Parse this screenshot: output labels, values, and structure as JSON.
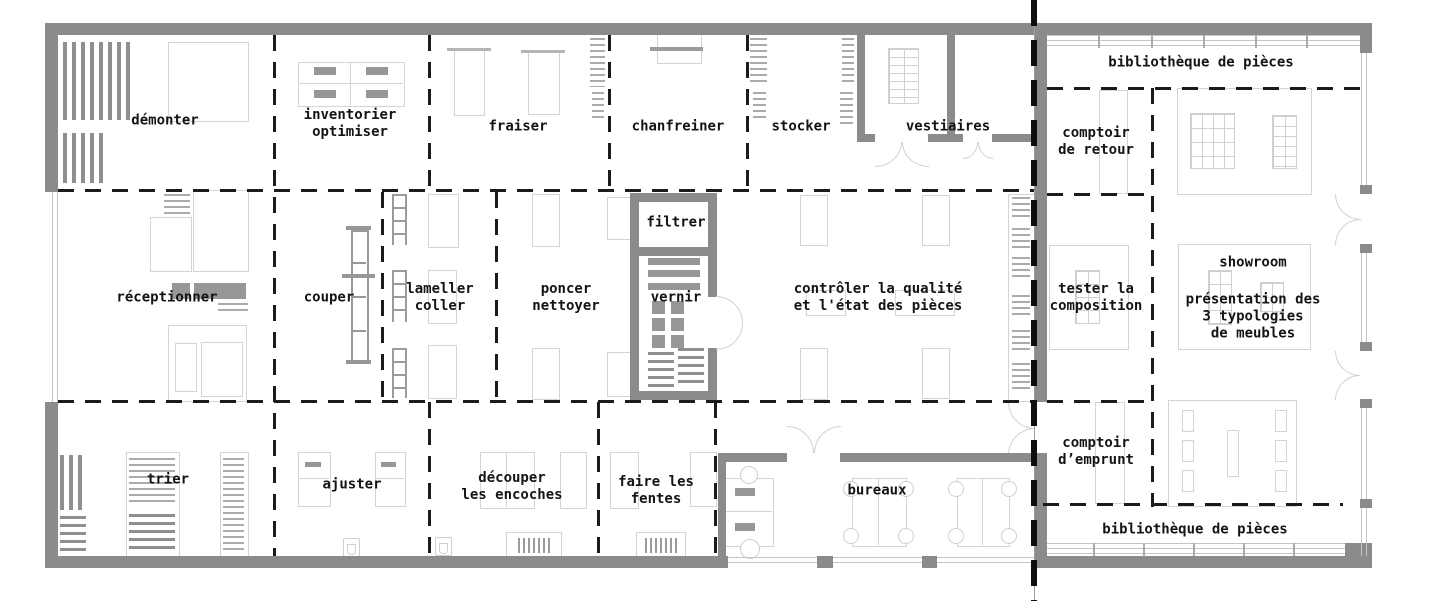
{
  "colors": {
    "wall": "#8b8b8b",
    "partition_line": "#1b1b1b",
    "section_cut_line": "#0e0e0e",
    "furniture_outline": "#d4d4d4",
    "furniture_fill": "#979797",
    "text": "#141414"
  },
  "rooms": [
    {
      "id": "demonter",
      "label": "démonter"
    },
    {
      "id": "inventorier-optimiser",
      "label": "inventorier\noptimiser"
    },
    {
      "id": "fraiser",
      "label": "fraiser"
    },
    {
      "id": "chanfreiner",
      "label": "chanfreiner"
    },
    {
      "id": "stocker",
      "label": "stocker"
    },
    {
      "id": "vestiaires",
      "label": "vestiaires"
    },
    {
      "id": "bibliotheque-haut",
      "label": "bibliothèque de pièces"
    },
    {
      "id": "comptoir-de-retour",
      "label": "comptoir\nde retour"
    },
    {
      "id": "receptionner",
      "label": "réceptionner"
    },
    {
      "id": "couper",
      "label": "couper"
    },
    {
      "id": "lameller-coller",
      "label": "lameller\ncoller"
    },
    {
      "id": "poncer-nettoyer",
      "label": "poncer\nnettoyer"
    },
    {
      "id": "filtrer",
      "label": "filtrer"
    },
    {
      "id": "vernir",
      "label": "vernir"
    },
    {
      "id": "controler-qualite",
      "label": "contrôler la qualité\net l'état des pièces"
    },
    {
      "id": "tester-composition",
      "label": "tester la\ncomposition"
    },
    {
      "id": "showroom-titre",
      "label": "showroom"
    },
    {
      "id": "showroom-description",
      "label": "présentation des\n3 typologies\nde meubles"
    },
    {
      "id": "trier",
      "label": "trier"
    },
    {
      "id": "ajuster",
      "label": "ajuster"
    },
    {
      "id": "decouper-encoches",
      "label": "découper\nles encoches"
    },
    {
      "id": "faire-les-fentes",
      "label": "faire les\nfentes"
    },
    {
      "id": "bureaux",
      "label": "bureaux"
    },
    {
      "id": "comptoir-emprunt",
      "label": "comptoir\nd’emprunt"
    },
    {
      "id": "bibliotheque-bas",
      "label": "bibliothèque de pièces"
    }
  ]
}
